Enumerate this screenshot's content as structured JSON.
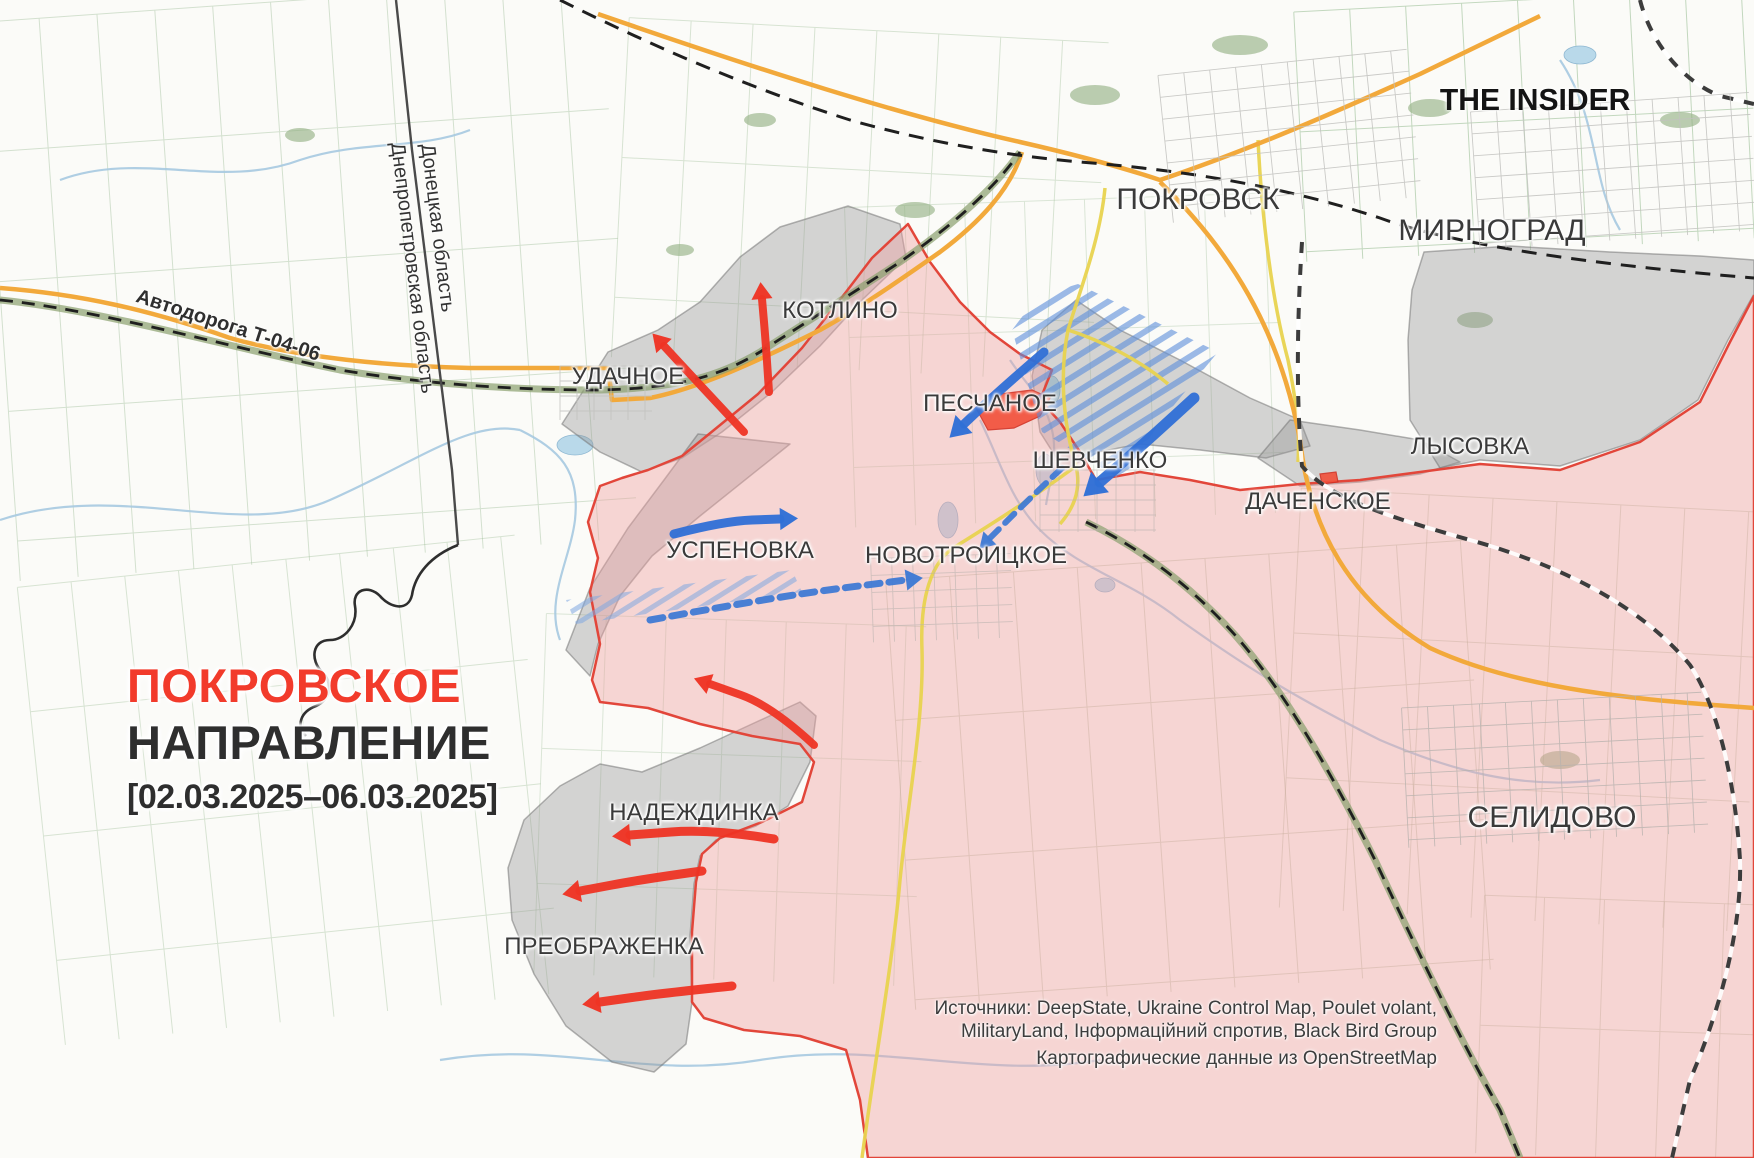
{
  "branding": {
    "logo_text": "THE INSIDER"
  },
  "title": {
    "line1": "ПОКРОВСКОЕ",
    "line2": "НАПРАВЛЕНИЕ",
    "date_range": "[02.03.2025–06.03.2025]",
    "accent_color": "#f23b2b",
    "text_color": "#2e2e2e"
  },
  "sources": {
    "line1": "Источники: DeepState, Ukraine Control Map, Poulet volant,",
    "line2": "MilitaryLand, Інформаційний спротив, Black Bird Group",
    "line3": "Картографические данные из OpenStreetMap"
  },
  "region_labels": [
    {
      "id": "donetsk-oblast",
      "text": "Донецкая область",
      "x": 437,
      "y": 228,
      "rotation": 83
    },
    {
      "id": "dnipro-oblast",
      "text": "Днепропетровская область",
      "x": 412,
      "y": 268,
      "rotation": 83
    }
  ],
  "road_label": {
    "text": "Автодорога Т-04-06",
    "x": 228,
    "y": 326,
    "rotation": 18
  },
  "cities": [
    {
      "id": "pokrovsk",
      "name": "ПОКРОВСК",
      "x": 1198,
      "y": 200,
      "size": 30
    },
    {
      "id": "mirnograd",
      "name": "МИРНОГРАД",
      "x": 1492,
      "y": 231,
      "size": 30
    },
    {
      "id": "selidovo",
      "name": "СЕЛИДОВО",
      "x": 1552,
      "y": 818,
      "size": 30
    },
    {
      "id": "kotlino",
      "name": "КОТЛИНО",
      "x": 840,
      "y": 311,
      "size": 24
    },
    {
      "id": "udachne",
      "name": "УДАЧНОЕ",
      "x": 628,
      "y": 377,
      "size": 24
    },
    {
      "id": "peschane",
      "name": "ПЕСЧАНОЕ",
      "x": 990,
      "y": 404,
      "size": 24
    },
    {
      "id": "shevchenko",
      "name": "ШЕВЧЕНКО",
      "x": 1100,
      "y": 461,
      "size": 24
    },
    {
      "id": "lysovka",
      "name": "ЛЫСОВКА",
      "x": 1470,
      "y": 447,
      "size": 24
    },
    {
      "id": "dachenske",
      "name": "ДАЧЕНСКОЕ",
      "x": 1318,
      "y": 502,
      "size": 24
    },
    {
      "id": "uspenovka",
      "name": "УСПЕНОВКА",
      "x": 740,
      "y": 551,
      "size": 24
    },
    {
      "id": "novotroitske",
      "name": "НОВОТРОИЦКОЕ",
      "x": 966,
      "y": 556,
      "size": 24
    },
    {
      "id": "nadezhdinka",
      "name": "НАДЕЖДИНКА",
      "x": 694,
      "y": 813,
      "size": 24
    },
    {
      "id": "preobrazhenka",
      "name": "ПРЕОБРАЖЕНКА",
      "x": 604,
      "y": 947,
      "size": 24
    }
  ],
  "map_colors": {
    "occupied_fill": "rgba(238,160,160,0.42)",
    "front_line": "#e2463a",
    "contested_fill": "rgba(148,148,148,0.38)",
    "contested_border": "rgba(118,118,118,0.55)",
    "recent_advance_fill": "#f2503a",
    "recent_advance_border": "#d23325",
    "red_arrow": "#ee3424",
    "blue_arrow": "#2f6fd6",
    "blue_dashed_arrow": "#3f7ad4",
    "hatch_blue": "#5b8ddb",
    "hatch_blue_light": "#7fa8e0",
    "road_orange": "#f2a93b",
    "road_yellow": "#e8d34f",
    "railway_black": "#1f1f1f"
  },
  "control_zones": {
    "occupied_points": [
      [
        908,
        224
      ],
      [
        872,
        258
      ],
      [
        846,
        292
      ],
      [
        802,
        348
      ],
      [
        758,
        394
      ],
      [
        714,
        430
      ],
      [
        682,
        456
      ],
      [
        648,
        470
      ],
      [
        622,
        478
      ],
      [
        600,
        486
      ],
      [
        588,
        522
      ],
      [
        598,
        558
      ],
      [
        590,
        592
      ],
      [
        600,
        644
      ],
      [
        592,
        680
      ],
      [
        600,
        702
      ],
      [
        648,
        708
      ],
      [
        700,
        724
      ],
      [
        752,
        736
      ],
      [
        800,
        744
      ],
      [
        814,
        762
      ],
      [
        802,
        802
      ],
      [
        762,
        822
      ],
      [
        720,
        838
      ],
      [
        702,
        854
      ],
      [
        696,
        882
      ],
      [
        692,
        932
      ],
      [
        692,
        1002
      ],
      [
        704,
        1018
      ],
      [
        744,
        1030
      ],
      [
        800,
        1036
      ],
      [
        846,
        1050
      ],
      [
        860,
        1100
      ],
      [
        868,
        1158
      ],
      [
        1754,
        1158
      ],
      [
        1754,
        296
      ],
      [
        1730,
        342
      ],
      [
        1700,
        402
      ],
      [
        1640,
        442
      ],
      [
        1560,
        470
      ],
      [
        1480,
        464
      ],
      [
        1420,
        472
      ],
      [
        1360,
        480
      ],
      [
        1300,
        484
      ],
      [
        1240,
        490
      ],
      [
        1190,
        480
      ],
      [
        1140,
        472
      ],
      [
        1096,
        480
      ],
      [
        1080,
        452
      ],
      [
        1060,
        422
      ],
      [
        1040,
        400
      ],
      [
        1052,
        370
      ],
      [
        1020,
        354
      ],
      [
        990,
        332
      ],
      [
        960,
        302
      ],
      [
        930,
        262
      ]
    ],
    "contested": [
      {
        "id": "kotlino-belt",
        "points": [
          [
            562,
            424
          ],
          [
            608,
            352
          ],
          [
            658,
            330
          ],
          [
            700,
            302
          ],
          [
            740,
            257
          ],
          [
            780,
            227
          ],
          [
            848,
            206
          ],
          [
            900,
            224
          ],
          [
            906,
            258
          ],
          [
            862,
            300
          ],
          [
            820,
            346
          ],
          [
            772,
            392
          ],
          [
            722,
            432
          ],
          [
            682,
            458
          ],
          [
            642,
            472
          ],
          [
            600,
            452
          ]
        ]
      },
      {
        "id": "uspenovka-strip",
        "points": [
          [
            698,
            434
          ],
          [
            790,
            444
          ],
          [
            700,
            516
          ],
          [
            652,
            556
          ],
          [
            620,
            596
          ],
          [
            598,
            644
          ],
          [
            590,
            676
          ],
          [
            566,
            650
          ],
          [
            590,
            588
          ],
          [
            628,
            528
          ],
          [
            664,
            480
          ]
        ]
      },
      {
        "id": "shevchenko-ne",
        "points": [
          [
            1042,
            330
          ],
          [
            1076,
            300
          ],
          [
            1120,
            330
          ],
          [
            1180,
            360
          ],
          [
            1250,
            398
          ],
          [
            1300,
            420
          ],
          [
            1310,
            446
          ],
          [
            1266,
            458
          ],
          [
            1200,
            450
          ],
          [
            1140,
            444
          ],
          [
            1098,
            452
          ],
          [
            1064,
            470
          ],
          [
            1040,
            432
          ],
          [
            1032,
            376
          ]
        ]
      },
      {
        "id": "dachenske-strip",
        "points": [
          [
            1290,
            420
          ],
          [
            1360,
            430
          ],
          [
            1420,
            440
          ],
          [
            1460,
            462
          ],
          [
            1420,
            474
          ],
          [
            1360,
            482
          ],
          [
            1300,
            486
          ],
          [
            1258,
            458
          ]
        ]
      },
      {
        "id": "nadezhdinka-blob",
        "points": [
          [
            800,
            702
          ],
          [
            816,
            716
          ],
          [
            810,
            762
          ],
          [
            788,
            806
          ],
          [
            756,
            826
          ],
          [
            716,
            840
          ],
          [
            700,
            856
          ],
          [
            694,
            884
          ],
          [
            690,
            936
          ],
          [
            692,
            1002
          ],
          [
            686,
            1044
          ],
          [
            654,
            1072
          ],
          [
            612,
            1062
          ],
          [
            566,
            1026
          ],
          [
            534,
            974
          ],
          [
            512,
            920
          ],
          [
            508,
            868
          ],
          [
            524,
            820
          ],
          [
            560,
            786
          ],
          [
            600,
            764
          ],
          [
            642,
            772
          ],
          [
            700,
            748
          ],
          [
            752,
            724
          ]
        ]
      },
      {
        "id": "mirnograd-south",
        "points": [
          [
            1424,
            252
          ],
          [
            1510,
            246
          ],
          [
            1610,
            252
          ],
          [
            1700,
            256
          ],
          [
            1754,
            260
          ],
          [
            1754,
            294
          ],
          [
            1728,
            340
          ],
          [
            1698,
            400
          ],
          [
            1640,
            440
          ],
          [
            1560,
            466
          ],
          [
            1480,
            460
          ],
          [
            1440,
            468
          ],
          [
            1410,
            420
          ],
          [
            1408,
            340
          ],
          [
            1412,
            290
          ]
        ]
      }
    ],
    "recent_advances": [
      {
        "id": "peschane-advance",
        "points": [
          [
            976,
            408
          ],
          [
            1000,
            394
          ],
          [
            1032,
            390
          ],
          [
            1050,
            398
          ],
          [
            1040,
            416
          ],
          [
            1014,
            428
          ],
          [
            988,
            430
          ]
        ]
      },
      {
        "id": "dachenske-advance",
        "points": [
          [
            1320,
            474
          ],
          [
            1336,
            472
          ],
          [
            1338,
            482
          ],
          [
            1322,
            484
          ]
        ]
      }
    ],
    "counterattack_hatched": [
      {
        "id": "shevchenko-hatch",
        "points": [
          [
            1038,
            296
          ],
          [
            1078,
            284
          ],
          [
            1218,
            352
          ],
          [
            1160,
            422
          ],
          [
            1122,
            480
          ],
          [
            1042,
            432
          ],
          [
            1012,
            330
          ]
        ],
        "pattern": "dense"
      },
      {
        "id": "uspenovka-hatch",
        "points": [
          [
            566,
            600
          ],
          [
            792,
            570
          ],
          [
            802,
            592
          ],
          [
            576,
            624
          ]
        ],
        "pattern": "light"
      }
    ]
  },
  "arrows": {
    "red_solid": [
      {
        "id": "kotlino-north",
        "points": [
          [
            769,
            392
          ],
          [
            766,
            345
          ],
          [
            762,
            299
          ]
        ],
        "width": 8,
        "head": 17
      },
      {
        "id": "udachne-northwest",
        "points": [
          [
            744,
            432
          ],
          [
            700,
            385
          ],
          [
            664,
            346
          ]
        ],
        "width": 8,
        "head": 17
      },
      {
        "id": "center-west",
        "points": [
          [
            814,
            745
          ],
          [
            772,
            706
          ],
          [
            710,
            684
          ]
        ],
        "width": 8,
        "head": 17
      },
      {
        "id": "nadezhdinka-west",
        "points": [
          [
            774,
            839
          ],
          [
            712,
            829
          ],
          [
            630,
            835
          ]
        ],
        "width": 9,
        "head": 18
      },
      {
        "id": "nadezhdinka-sw",
        "points": [
          [
            702,
            871
          ],
          [
            644,
            879
          ],
          [
            580,
            891
          ]
        ],
        "width": 9,
        "head": 18
      },
      {
        "id": "preobrazhenka-west",
        "points": [
          [
            732,
            986
          ],
          [
            664,
            993
          ],
          [
            600,
            1002
          ]
        ],
        "width": 9,
        "head": 18
      }
    ],
    "blue_solid": [
      {
        "id": "peschane-southwest",
        "points": [
          [
            1044,
            352
          ],
          [
            1000,
            390
          ],
          [
            964,
            424
          ]
        ],
        "width": 9,
        "head": 20
      },
      {
        "id": "shevchenko-southwest",
        "points": [
          [
            1194,
            398
          ],
          [
            1146,
            442
          ],
          [
            1100,
            482
          ]
        ],
        "width": 11,
        "head": 22
      },
      {
        "id": "uspenovka-east",
        "points": [
          [
            674,
            534
          ],
          [
            724,
            521
          ],
          [
            780,
            519
          ]
        ],
        "width": 9,
        "head": 18
      }
    ],
    "blue_dashed": [
      {
        "id": "shevchenko-dash-sw",
        "points": [
          [
            1062,
            468
          ],
          [
            1026,
            502
          ],
          [
            990,
            538
          ]
        ],
        "width": 6,
        "head": 15
      },
      {
        "id": "novotroitske-dash-e",
        "points": [
          [
            650,
            620
          ],
          [
            780,
            596
          ],
          [
            906,
            580
          ]
        ],
        "width": 7,
        "head": 17
      }
    ]
  }
}
